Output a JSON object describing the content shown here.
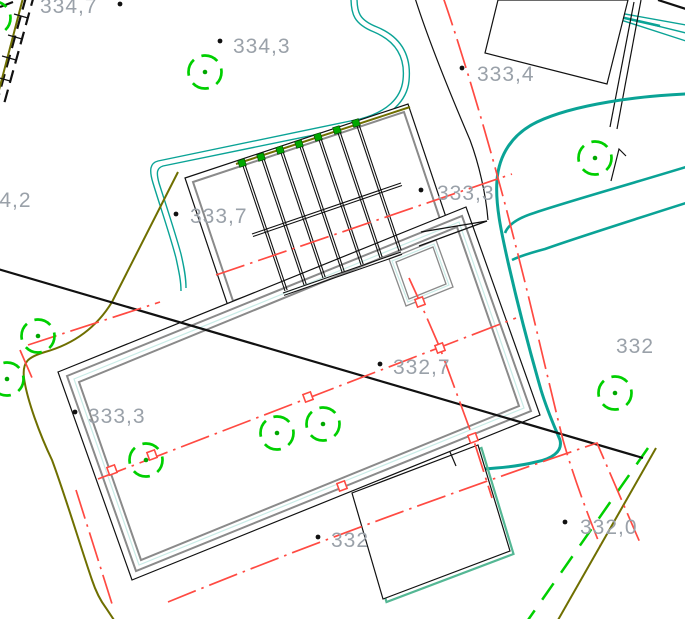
{
  "canvas": {
    "width": 685,
    "height": 619,
    "background": "#ffffff"
  },
  "colors": {
    "teal": "#0aa396",
    "teal_light": "#c9ece7",
    "olive": "#6f6f00",
    "red": "#ff4a42",
    "green": "#00cf00",
    "green_dark": "#00a800",
    "gray_line": "#8a8a8a",
    "text_gray": "#9aa1a9",
    "black": "#111111",
    "dark_red_dot": "#8b0000",
    "bg": "#ffffff"
  },
  "labels": [
    {
      "text": "334,7"
    },
    {
      "text": "334,3"
    },
    {
      "text": "333,4"
    },
    {
      "text": "334,2"
    },
    {
      "text": "333,7"
    },
    {
      "text": "333,3"
    },
    {
      "text": "332,7"
    },
    {
      "text": "333,3"
    },
    {
      "text": "332"
    },
    {
      "text": "332,0"
    },
    {
      "text": "332"
    }
  ]
}
